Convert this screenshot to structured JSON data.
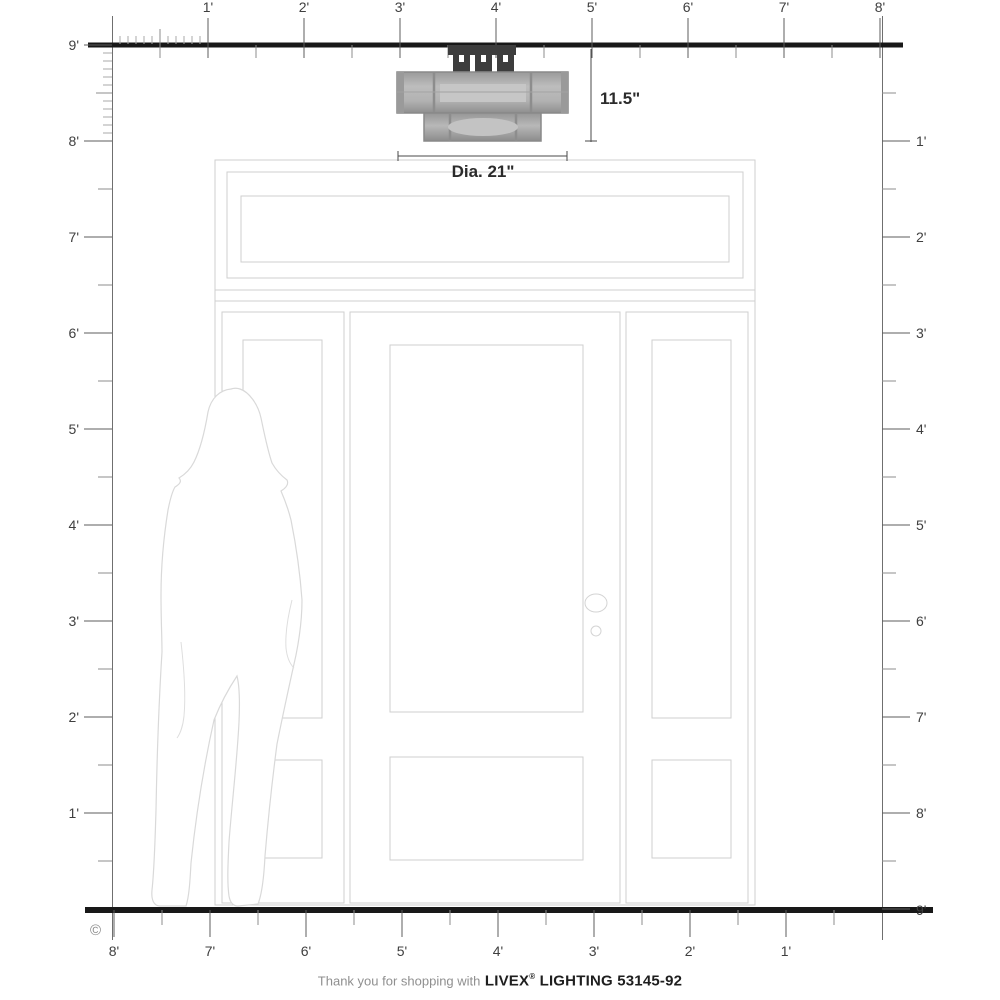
{
  "rulers": {
    "top": {
      "labels": [
        "1'",
        "2'",
        "3'",
        "4'",
        "5'",
        "6'",
        "7'",
        "8'"
      ]
    },
    "left": {
      "labels": [
        "9'",
        "8'",
        "7'",
        "6'",
        "5'",
        "4'",
        "3'",
        "2'",
        "1'"
      ]
    },
    "right": {
      "labels": [
        "1'",
        "2'",
        "3'",
        "4'",
        "5'",
        "6'",
        "7'",
        "8'",
        "9'"
      ]
    },
    "bottom": {
      "labels": [
        "8'",
        "7'",
        "6'",
        "5'",
        "4'",
        "3'",
        "2'",
        "1'"
      ]
    }
  },
  "fixture": {
    "height_label": "11.5\"",
    "diameter_label": "Dia. 21\""
  },
  "footer": {
    "copyright": "©",
    "prefix": "Thank you for shopping with",
    "brand": "LIVEX",
    "reg": "®",
    "suffix": "LIGHTING 53145-92"
  },
  "colors": {
    "ruler_thick_line": "#181818",
    "ruler_tick": "#6b6b6b",
    "door_outline": "#cfcfcf",
    "silhouette_outline": "#d9d9d9",
    "fixture_mount": "#3d3d3d",
    "fixture_body": "#b3b3b3",
    "dimension_line": "#4a4a4a"
  }
}
